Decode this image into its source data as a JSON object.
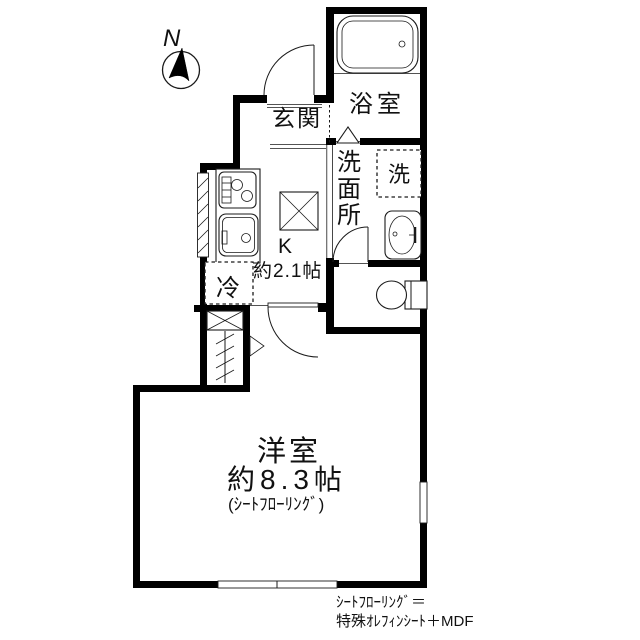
{
  "floorplan": {
    "compass_label": "N",
    "labels": {
      "genkan": "玄関",
      "bath": "浴室",
      "washroom_c1": "洗",
      "washroom_c2": "面",
      "washroom_c3": "所",
      "laundry": "洗",
      "kitchen_label": "K",
      "kitchen_size": "約2.1帖",
      "fridge": "冷",
      "room_label": "洋室",
      "room_size": "約8.3帖",
      "room_floor_note": "(ｼｰﾄﾌﾛｰﾘﾝｸﾞ)"
    },
    "footer": {
      "line1": "ｼｰﾄﾌﾛｰﾘﾝｸﾞ＝",
      "line2": "特殊ｵﾚﾌｨﾝｼｰﾄ＋MDF"
    },
    "colors": {
      "wall": "#000000",
      "background": "#ffffff",
      "text": "#111111"
    }
  }
}
